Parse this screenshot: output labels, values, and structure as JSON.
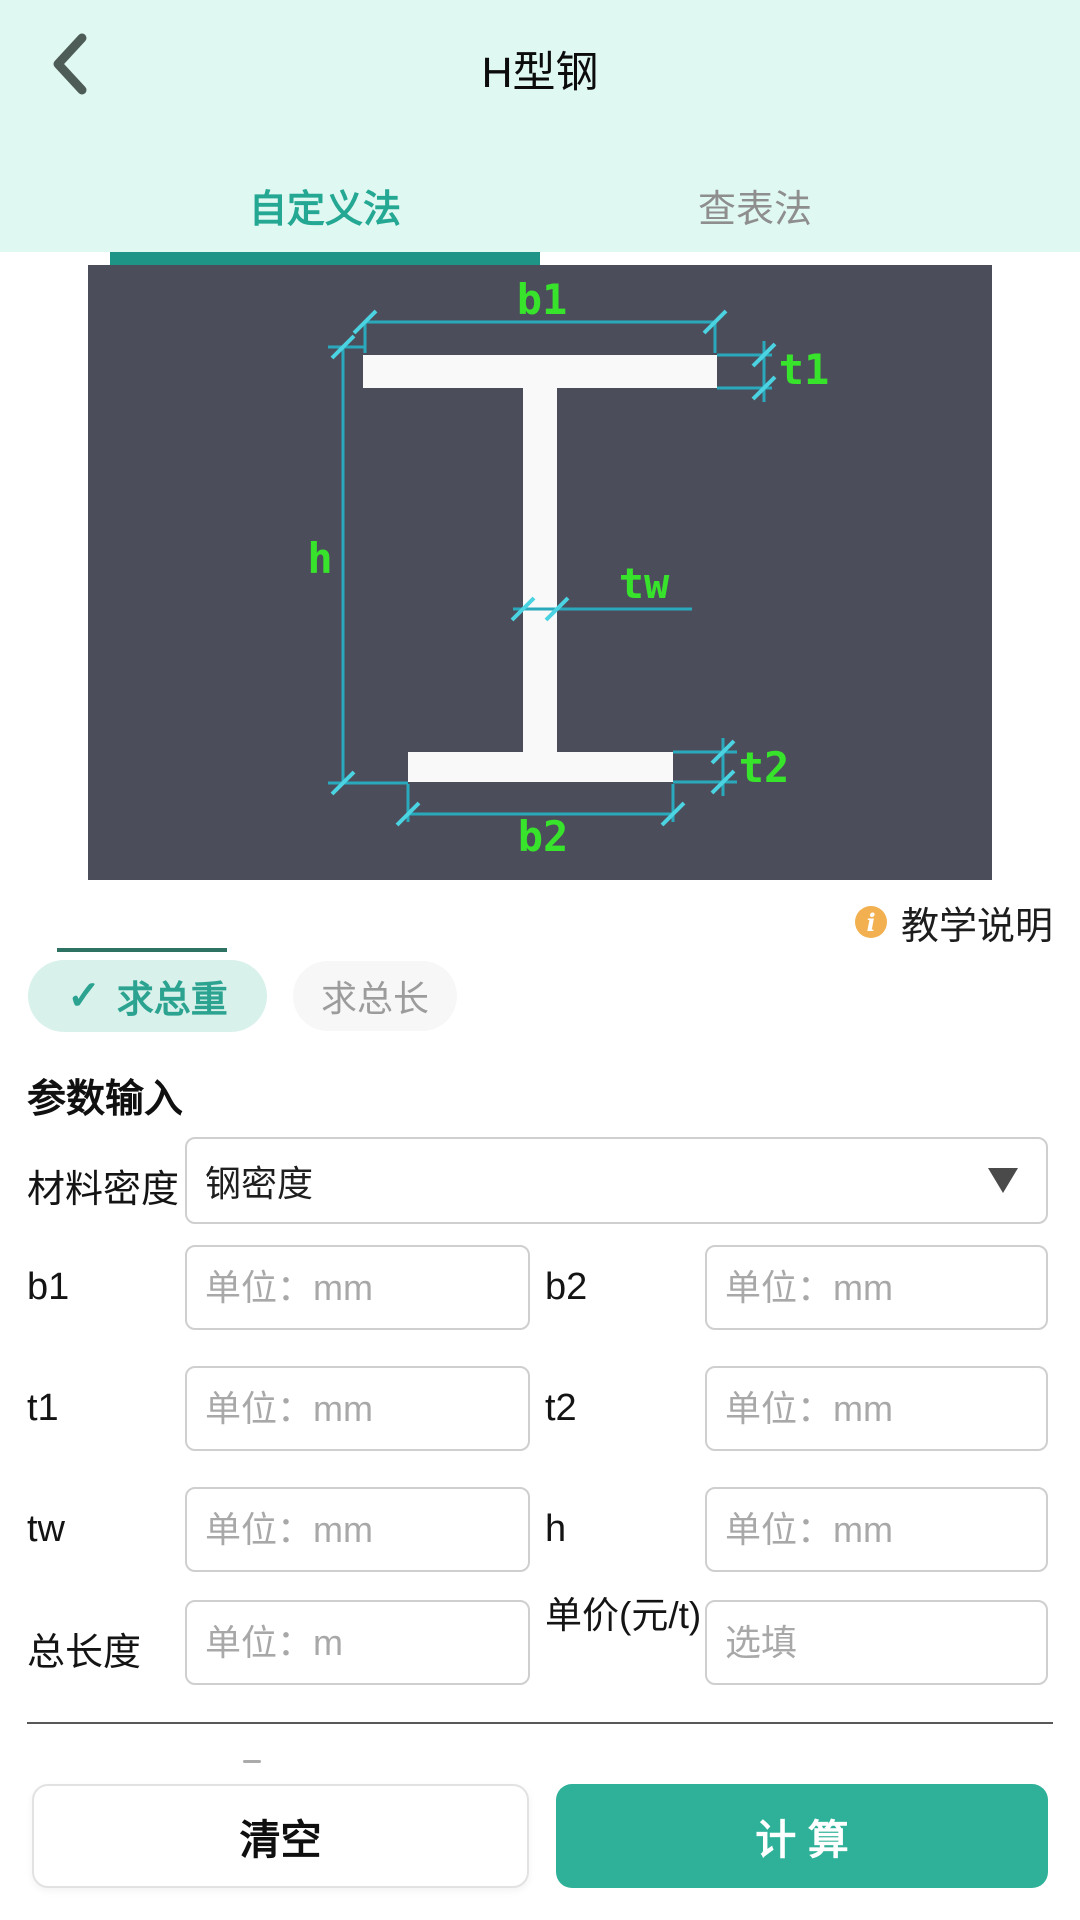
{
  "header": {
    "title": "H型钢"
  },
  "tabs": {
    "custom": "自定义法",
    "lookup": "查表法",
    "active": "自定义法"
  },
  "diagram": {
    "background": "#4b4e5a",
    "beam_color": "#f9f9f9",
    "line_color": "#2aa9bc",
    "tick_color": "#4bd3e2",
    "label_color": "#38e42b",
    "labels": {
      "b1": "b1",
      "t1": "t1",
      "h": "h",
      "tw": "tw",
      "t2": "t2",
      "b2": "b2"
    }
  },
  "help": {
    "icon": "i",
    "label": "教学说明"
  },
  "mode_toggle": {
    "weight": {
      "label": "求总重",
      "selected": true,
      "check": "✓"
    },
    "length": {
      "label": "求总长",
      "selected": false
    }
  },
  "form": {
    "section_title": "参数输入",
    "density": {
      "label": "材料密度",
      "value": "钢密度"
    },
    "fields": [
      {
        "label": "b1",
        "placeholder": "单位：mm"
      },
      {
        "label": "b2",
        "placeholder": "单位：mm"
      },
      {
        "label": "t1",
        "placeholder": "单位：mm"
      },
      {
        "label": "t2",
        "placeholder": "单位：mm"
      },
      {
        "label": "tw",
        "placeholder": "单位：mm"
      },
      {
        "label": "h",
        "placeholder": "单位：mm"
      },
      {
        "label": "总长度",
        "placeholder": "单位：m"
      },
      {
        "label": "单价(元/t)",
        "placeholder": "选填"
      }
    ]
  },
  "actions": {
    "clear": "清空",
    "calculate": "计 算"
  },
  "colors": {
    "header_bg": "#e0f8f2",
    "accent_teal": "#2fb199",
    "tab_active": "#25a893",
    "underline": "#1e9486",
    "pill_selected_bg": "#d9f1eb",
    "info_icon": "#f2b050"
  }
}
